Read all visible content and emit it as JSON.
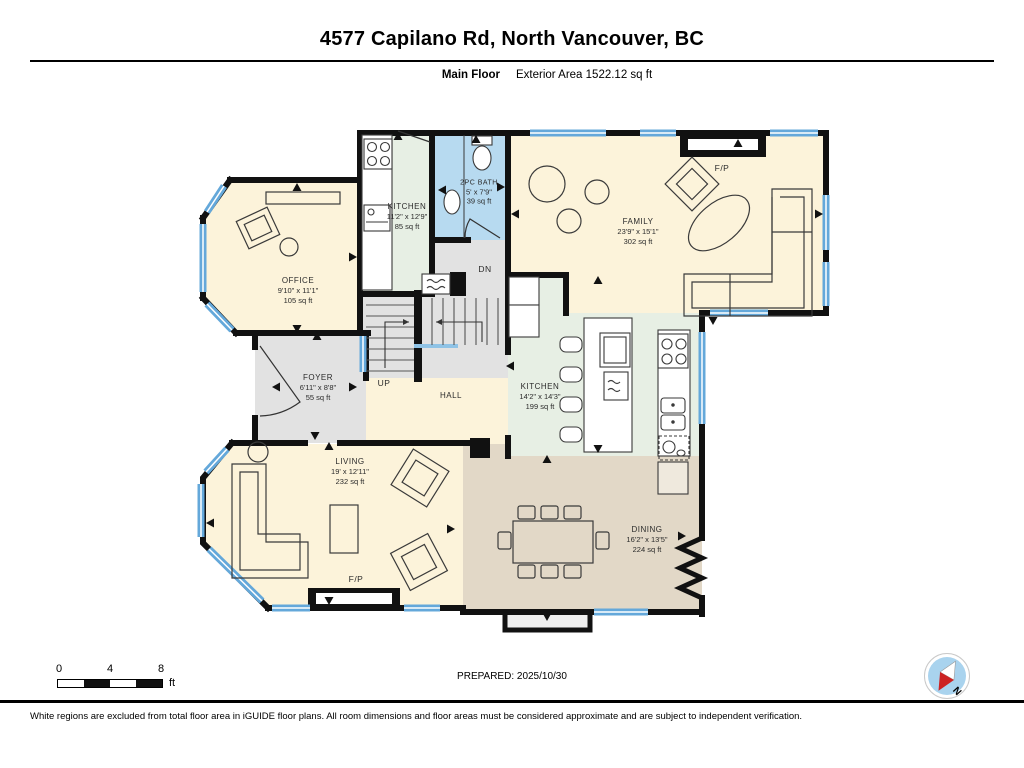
{
  "header": {
    "title": "4577 Capilano Rd, North Vancouver, BC",
    "floor_label": "Main Floor",
    "area_label": "Exterior Area 1522.12 sq ft"
  },
  "rooms": {
    "office": {
      "name": "OFFICE",
      "dims": "9'10\" x 11'1\"",
      "area": "105 sq ft"
    },
    "kitchen_small": {
      "name": "KITCHEN",
      "dims": "11'2\" x 12'9\"",
      "area": "85 sq ft"
    },
    "bath": {
      "name": "2PC BATH",
      "dims": "5' x 7'9\"",
      "area": "39 sq ft"
    },
    "family": {
      "name": "FAMILY",
      "dims": "23'9\" x 15'1\"",
      "area": "302 sq ft"
    },
    "foyer": {
      "name": "FOYER",
      "dims": "6'11\" x 8'8\"",
      "area": "55 sq ft"
    },
    "hall": {
      "name": "HALL"
    },
    "kitchen_main": {
      "name": "KITCHEN",
      "dims": "14'2\" x 14'3\"",
      "area": "199 sq ft"
    },
    "living": {
      "name": "LIVING",
      "dims": "19' x 12'11\"",
      "area": "232 sq ft"
    },
    "dining": {
      "name": "DINING",
      "dims": "16'2\" x 13'5\"",
      "area": "224 sq ft"
    }
  },
  "plan_labels": {
    "up": "UP",
    "down": "DN",
    "fireplace_family": "F/P",
    "fireplace_living": "F/P",
    "north": "N"
  },
  "footer": {
    "prepared": "PREPARED: 2025/10/30",
    "scale_ticks": [
      "0",
      "4",
      "8"
    ],
    "scale_unit": "ft",
    "disclaimer": "White regions are excluded from total floor area in iGUIDE floor plans. All room dimensions and floor areas must be considered approximate and are subject to independent verification."
  },
  "colors": {
    "room_cream": "#fcf3da",
    "room_green": "#e7efe4",
    "room_blue": "#b7daf0",
    "room_gray": "#e2e2e2",
    "room_tan": "#e2d8c7",
    "window_blue": "#64a8da",
    "wall": "#111111",
    "compass_fill": "#a9d3ee",
    "compass_red": "#cc2222"
  }
}
